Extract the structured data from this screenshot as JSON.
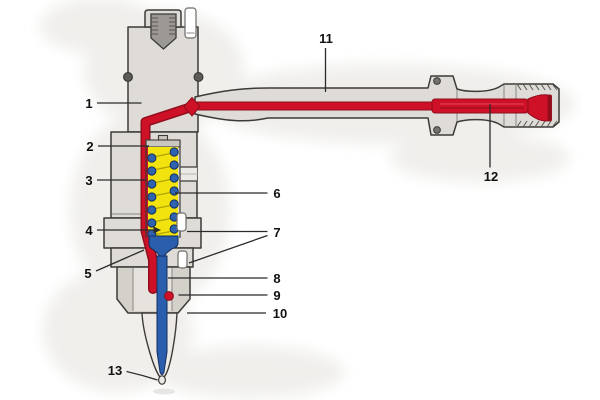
{
  "colors": {
    "metal": "#dfdcd7",
    "metal_dark": "#d4d1cb",
    "outline": "#3d3b38",
    "fuel_red": "#ce1126",
    "fuel_red_dark": "#8f0d1c",
    "spring_yellow": "#f2e30e",
    "coil_blue": "#2f63af",
    "needle_blue": "#2a5dab",
    "thread_gray": "#9c9995",
    "label": "#111111"
  },
  "callouts": [
    {
      "num": "1"
    },
    {
      "num": "2"
    },
    {
      "num": "3"
    },
    {
      "num": "4"
    },
    {
      "num": "5"
    },
    {
      "num": "6"
    },
    {
      "num": "7"
    },
    {
      "num": "8"
    },
    {
      "num": "9"
    },
    {
      "num": "10"
    },
    {
      "num": "11"
    },
    {
      "num": "12"
    },
    {
      "num": "13"
    }
  ]
}
